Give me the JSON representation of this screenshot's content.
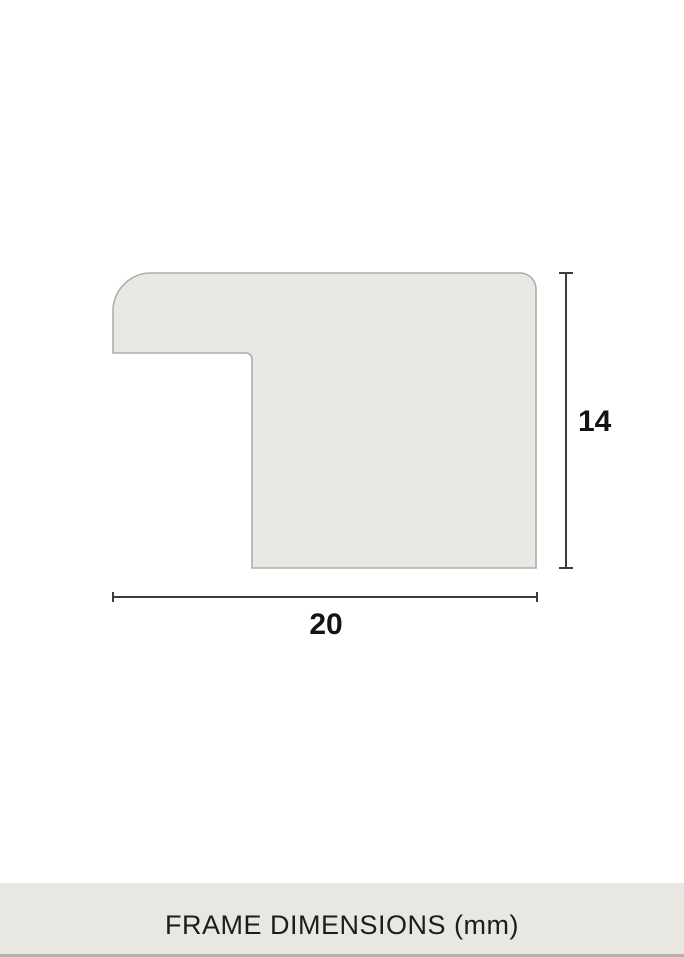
{
  "diagram": {
    "profile": {
      "fill": "#e9e8e4",
      "stroke": "#aeada9"
    },
    "dimensions": {
      "height_label": "14",
      "width_label": "20",
      "line_color": "#3b3b3b",
      "label_color": "#141414"
    }
  },
  "caption": {
    "text": "FRAME DIMENSIONS (mm)",
    "background": "#e8e7e2",
    "text_color": "#1e1d1b",
    "bottom_edge_color": "#b3b2ae"
  }
}
